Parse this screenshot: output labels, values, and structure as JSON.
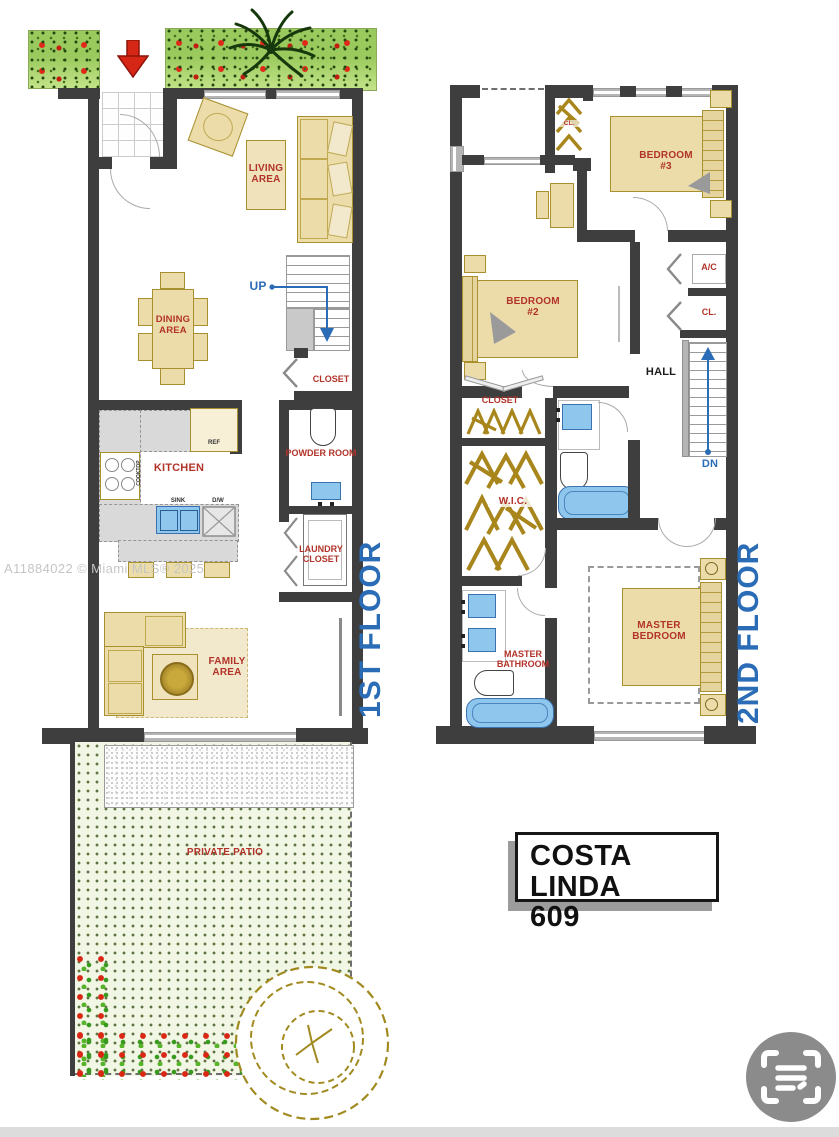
{
  "watermark": "A11884022 © Miami MLS® 2025",
  "plate": {
    "line1": "COSTA LINDA",
    "line2": "609"
  },
  "floor1": {
    "title": "1ST FLOOR",
    "entrance": "ENTRANCE",
    "living": "LIVING AREA",
    "dining": "DINING AREA",
    "up": "UP",
    "closet": "CLOSET",
    "kitchen": "KITCHEN",
    "ref": "REF",
    "cooktop": "COOKTOP",
    "sink": "SINK",
    "dw": "D/W",
    "powder": "POWDER ROOM",
    "laundry": "LAUNDRY CLOSET",
    "family": "FAMILY AREA",
    "patio": "PRIVATE PATIO"
  },
  "floor2": {
    "title": "2ND FLOOR",
    "cl_top": "CL.",
    "bedroom3": "BEDROOM #3",
    "bedroom2": "BEDROOM #2",
    "ac": "A/C",
    "cl": "CL.",
    "hall": "HALL",
    "dn": "DN",
    "closet": "CLOSET",
    "wic": "W.I.C.",
    "master_bathroom": "MASTER BATHROOM",
    "master_bedroom": "MASTER BEDROOM"
  },
  "colors": {
    "wall": "#3e3e3e",
    "label_red": "#b23329",
    "plan_blue": "#2b6cb6",
    "furniture_tan": "#ecdcaa",
    "furniture_border": "#a8902f",
    "fixture_blue": "#8fc6ee",
    "hanger_gold": "#a8861c"
  }
}
